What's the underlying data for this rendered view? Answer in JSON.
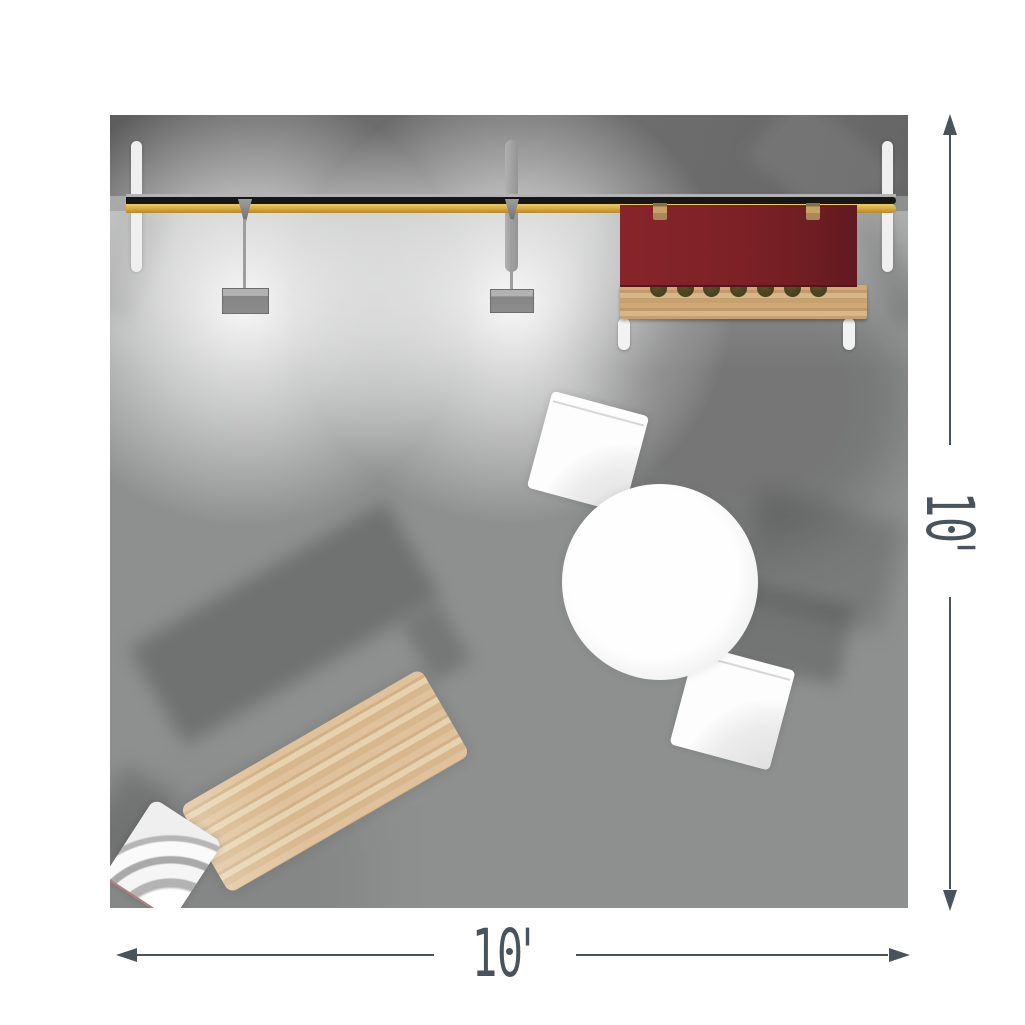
{
  "scene": {
    "title": "10x10 trade show booth top view",
    "objects": [
      "back-wall-beam",
      "wall-post-left",
      "wall-post-center",
      "wall-post-right",
      "pendant-light-1",
      "pendant-light-2",
      "red-counter",
      "counter-bottle-rack",
      "counter-hooks",
      "counter-legs",
      "round-table",
      "chair-top",
      "chair-bottom",
      "side-chair",
      "wooden-desk"
    ],
    "bottle_count": 7
  },
  "dimensions": {
    "bottom": {
      "label": "10'"
    },
    "right": {
      "label": "10'"
    }
  },
  "colors": {
    "floor": "#8e8f8f",
    "band": "#6a6a6a",
    "gold": "#d9ae45",
    "gold-light": "#efcb66",
    "gold-dark": "#b48a2c",
    "beam-black": "#161616",
    "red": "#7d2127",
    "red-light": "#87242b",
    "red-dark": "#601920",
    "wood": "#dcbf97",
    "post": "#efefef",
    "olive": "#46401c",
    "hook": "#c6a265",
    "dim": "#4a525c"
  }
}
